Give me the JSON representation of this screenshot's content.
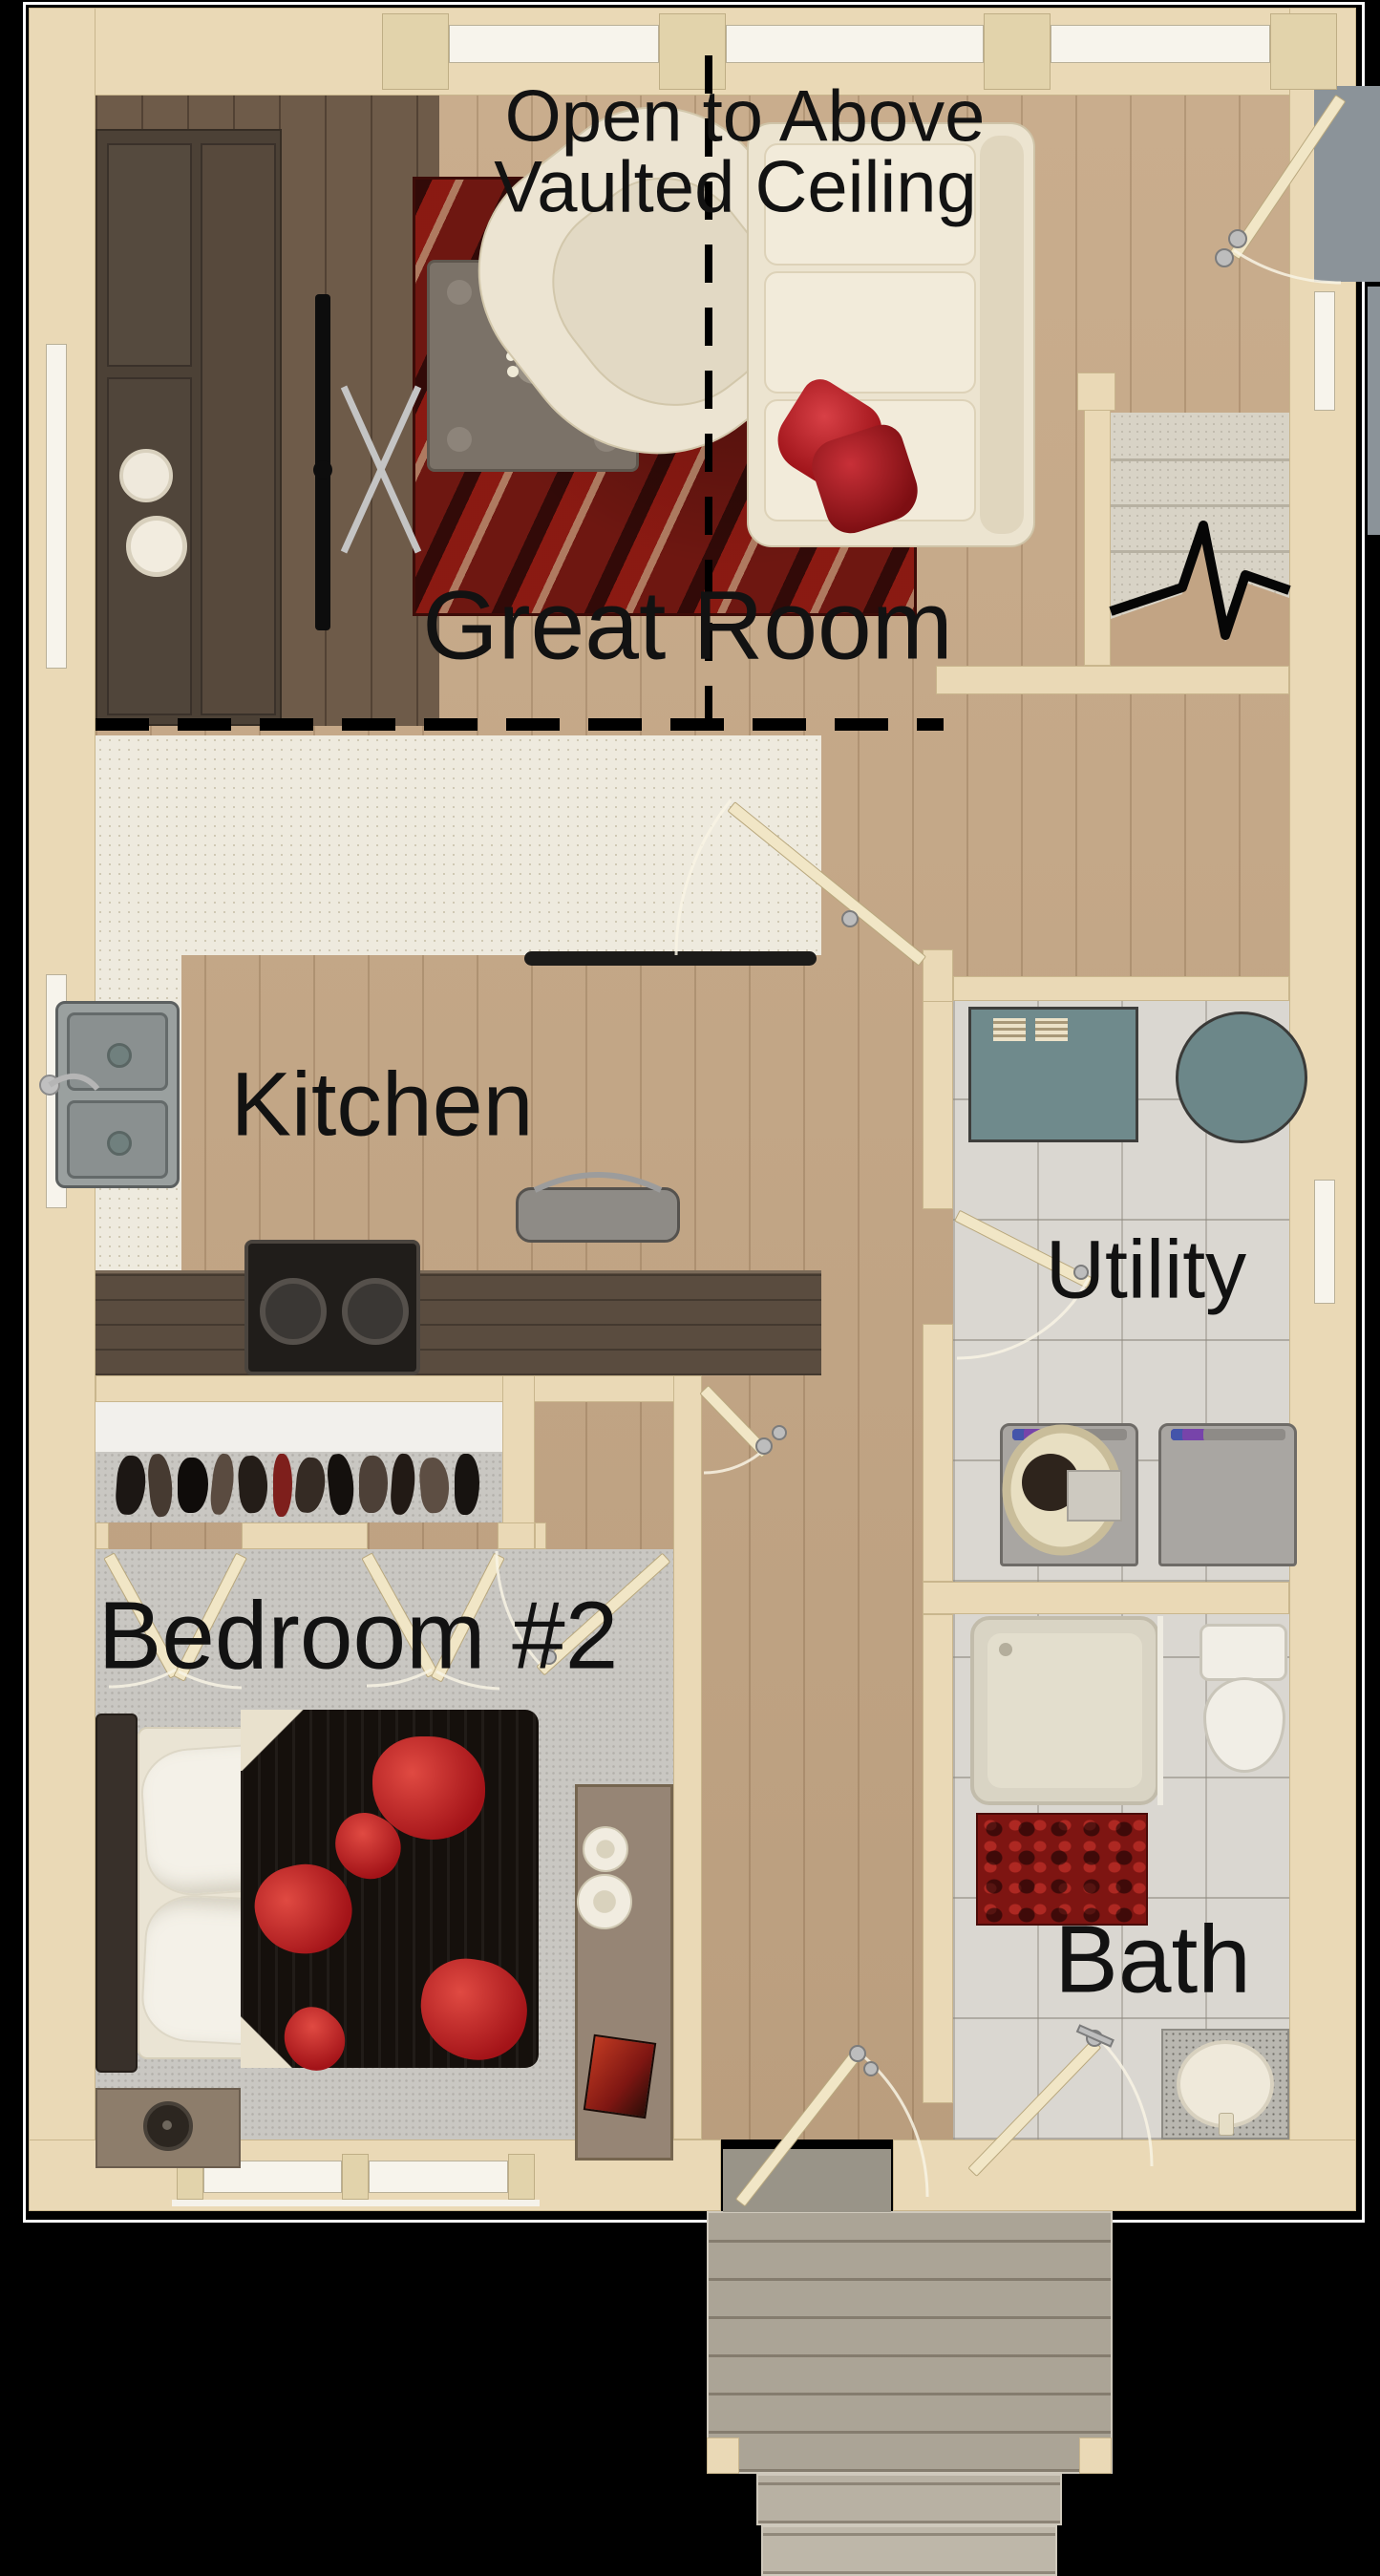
{
  "plan": {
    "note": {
      "line1": "Open to Above",
      "line2": "Vaulted Ceiling"
    },
    "rooms": {
      "great_room": {
        "label": "Great Room"
      },
      "kitchen": {
        "label": "Kitchen"
      },
      "utility": {
        "label": "Utility"
      },
      "bedroom2": {
        "label": "Bedroom #2"
      },
      "bath": {
        "label": "Bath"
      }
    },
    "features": {
      "great_room": [
        "media-console",
        "tv",
        "armchair",
        "area-rug",
        "coffee-table",
        "sofa",
        "stairs",
        "front-door"
      ],
      "kitchen": [
        "double-sink",
        "peninsula-counter",
        "cooktop",
        "roaster",
        "lower-counter"
      ],
      "utility": [
        "folding-table",
        "round-rug",
        "washer",
        "dryer",
        "laundry-basket"
      ],
      "bedroom2": [
        "closet-with-clothes",
        "double-bed",
        "nightstand",
        "dresser",
        "candles",
        "window"
      ],
      "bath": [
        "shower",
        "toilet",
        "bath-mat",
        "vanity-sink"
      ],
      "exterior": [
        "rear-deck",
        "deck-steps",
        "entry-porch"
      ]
    },
    "colors": {
      "wall": "#ead9b6",
      "wood_floor": "#c6a886",
      "dark_wood": "#5a4c3f",
      "tile": "#dad7d1",
      "carpet": "#c9c7c2",
      "teal": "#6f8a8c",
      "rug_red": "#6e1711",
      "accent_red": "#c0262a",
      "deck": "#aba496",
      "porch": "#8b9399",
      "text": "#121212"
    }
  }
}
